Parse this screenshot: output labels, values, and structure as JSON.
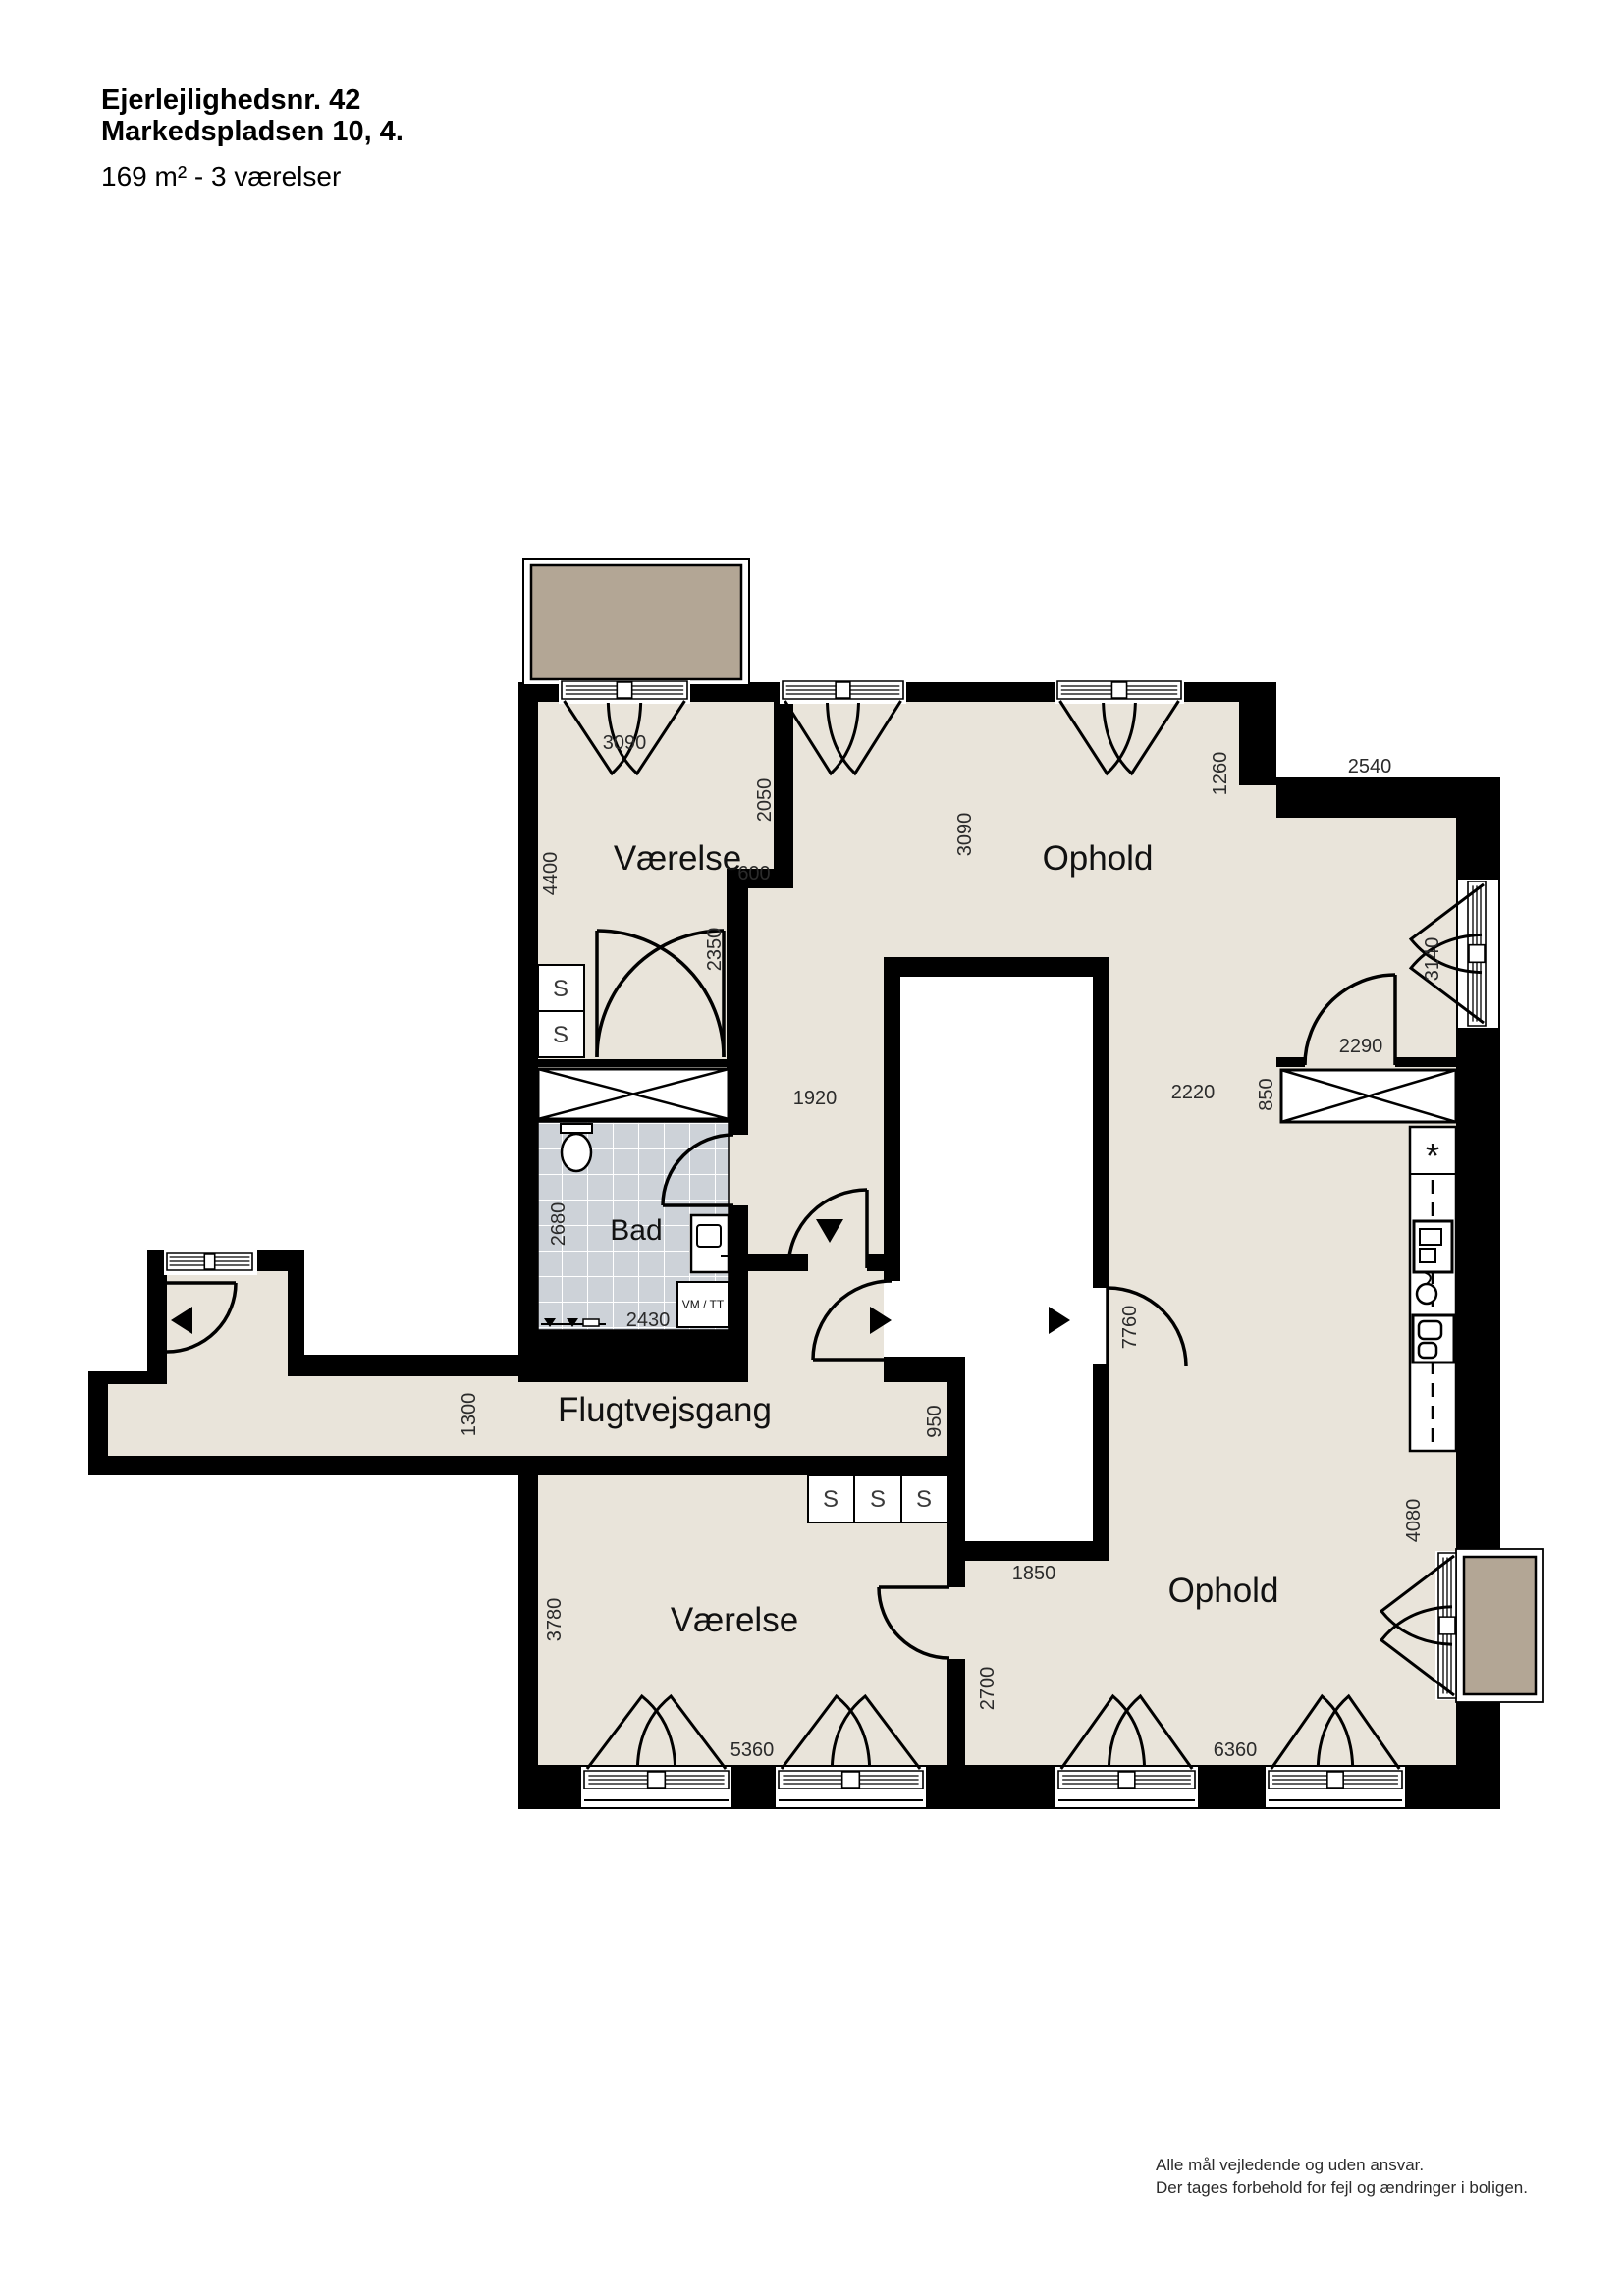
{
  "header": {
    "lot_number": "Ejerlejlighedsnr. 42",
    "address": "Markedspladsen 10, 4.",
    "size_rooms": "169 m² - 3 værelser"
  },
  "footer": {
    "line1": "Alle mål vejledende og uden ansvar.",
    "line2": "Der tages forbehold for fejl og ændringer i boligen."
  },
  "rooms": {
    "bedroom_top": "Værelse",
    "living_top": "Ophold",
    "bathroom": "Bad",
    "corridor": "Flugtvejsgang",
    "bedroom_bottom": "Værelse",
    "living_bottom": "Ophold"
  },
  "fixtures": {
    "washer_dryer": "VM / TT",
    "cabinet": "S",
    "fridge_symbol": "*"
  },
  "dims": {
    "top_window": "3090",
    "bedroom_wall_upper": "2050",
    "bedroom_height": "4400",
    "wall_jog": "600",
    "bedroom_wall_lower": "2350",
    "living_top_depth": "3090",
    "living_corner": "1260",
    "living_top_width": "2540",
    "side_window": "3140",
    "closet_door": "2290",
    "closet_side": "850",
    "hall_width": "1920",
    "living_gap": "2220",
    "living_side_height": "7760",
    "bath_depth": "2680",
    "bath_width": "2430",
    "corridor_width": "1300",
    "corridor_end": "950",
    "bedroom2_depth": "3780",
    "bedroom2_window": "5360",
    "shaft_bottom": "1850",
    "bedroom2_wall": "2700",
    "living_bottom_window": "6360",
    "living_right_wall": "4080"
  },
  "colors": {
    "floor": "#e9e4da",
    "balcony": "#b3a695",
    "tile": "#cdd2d8",
    "wall": "#000000"
  }
}
